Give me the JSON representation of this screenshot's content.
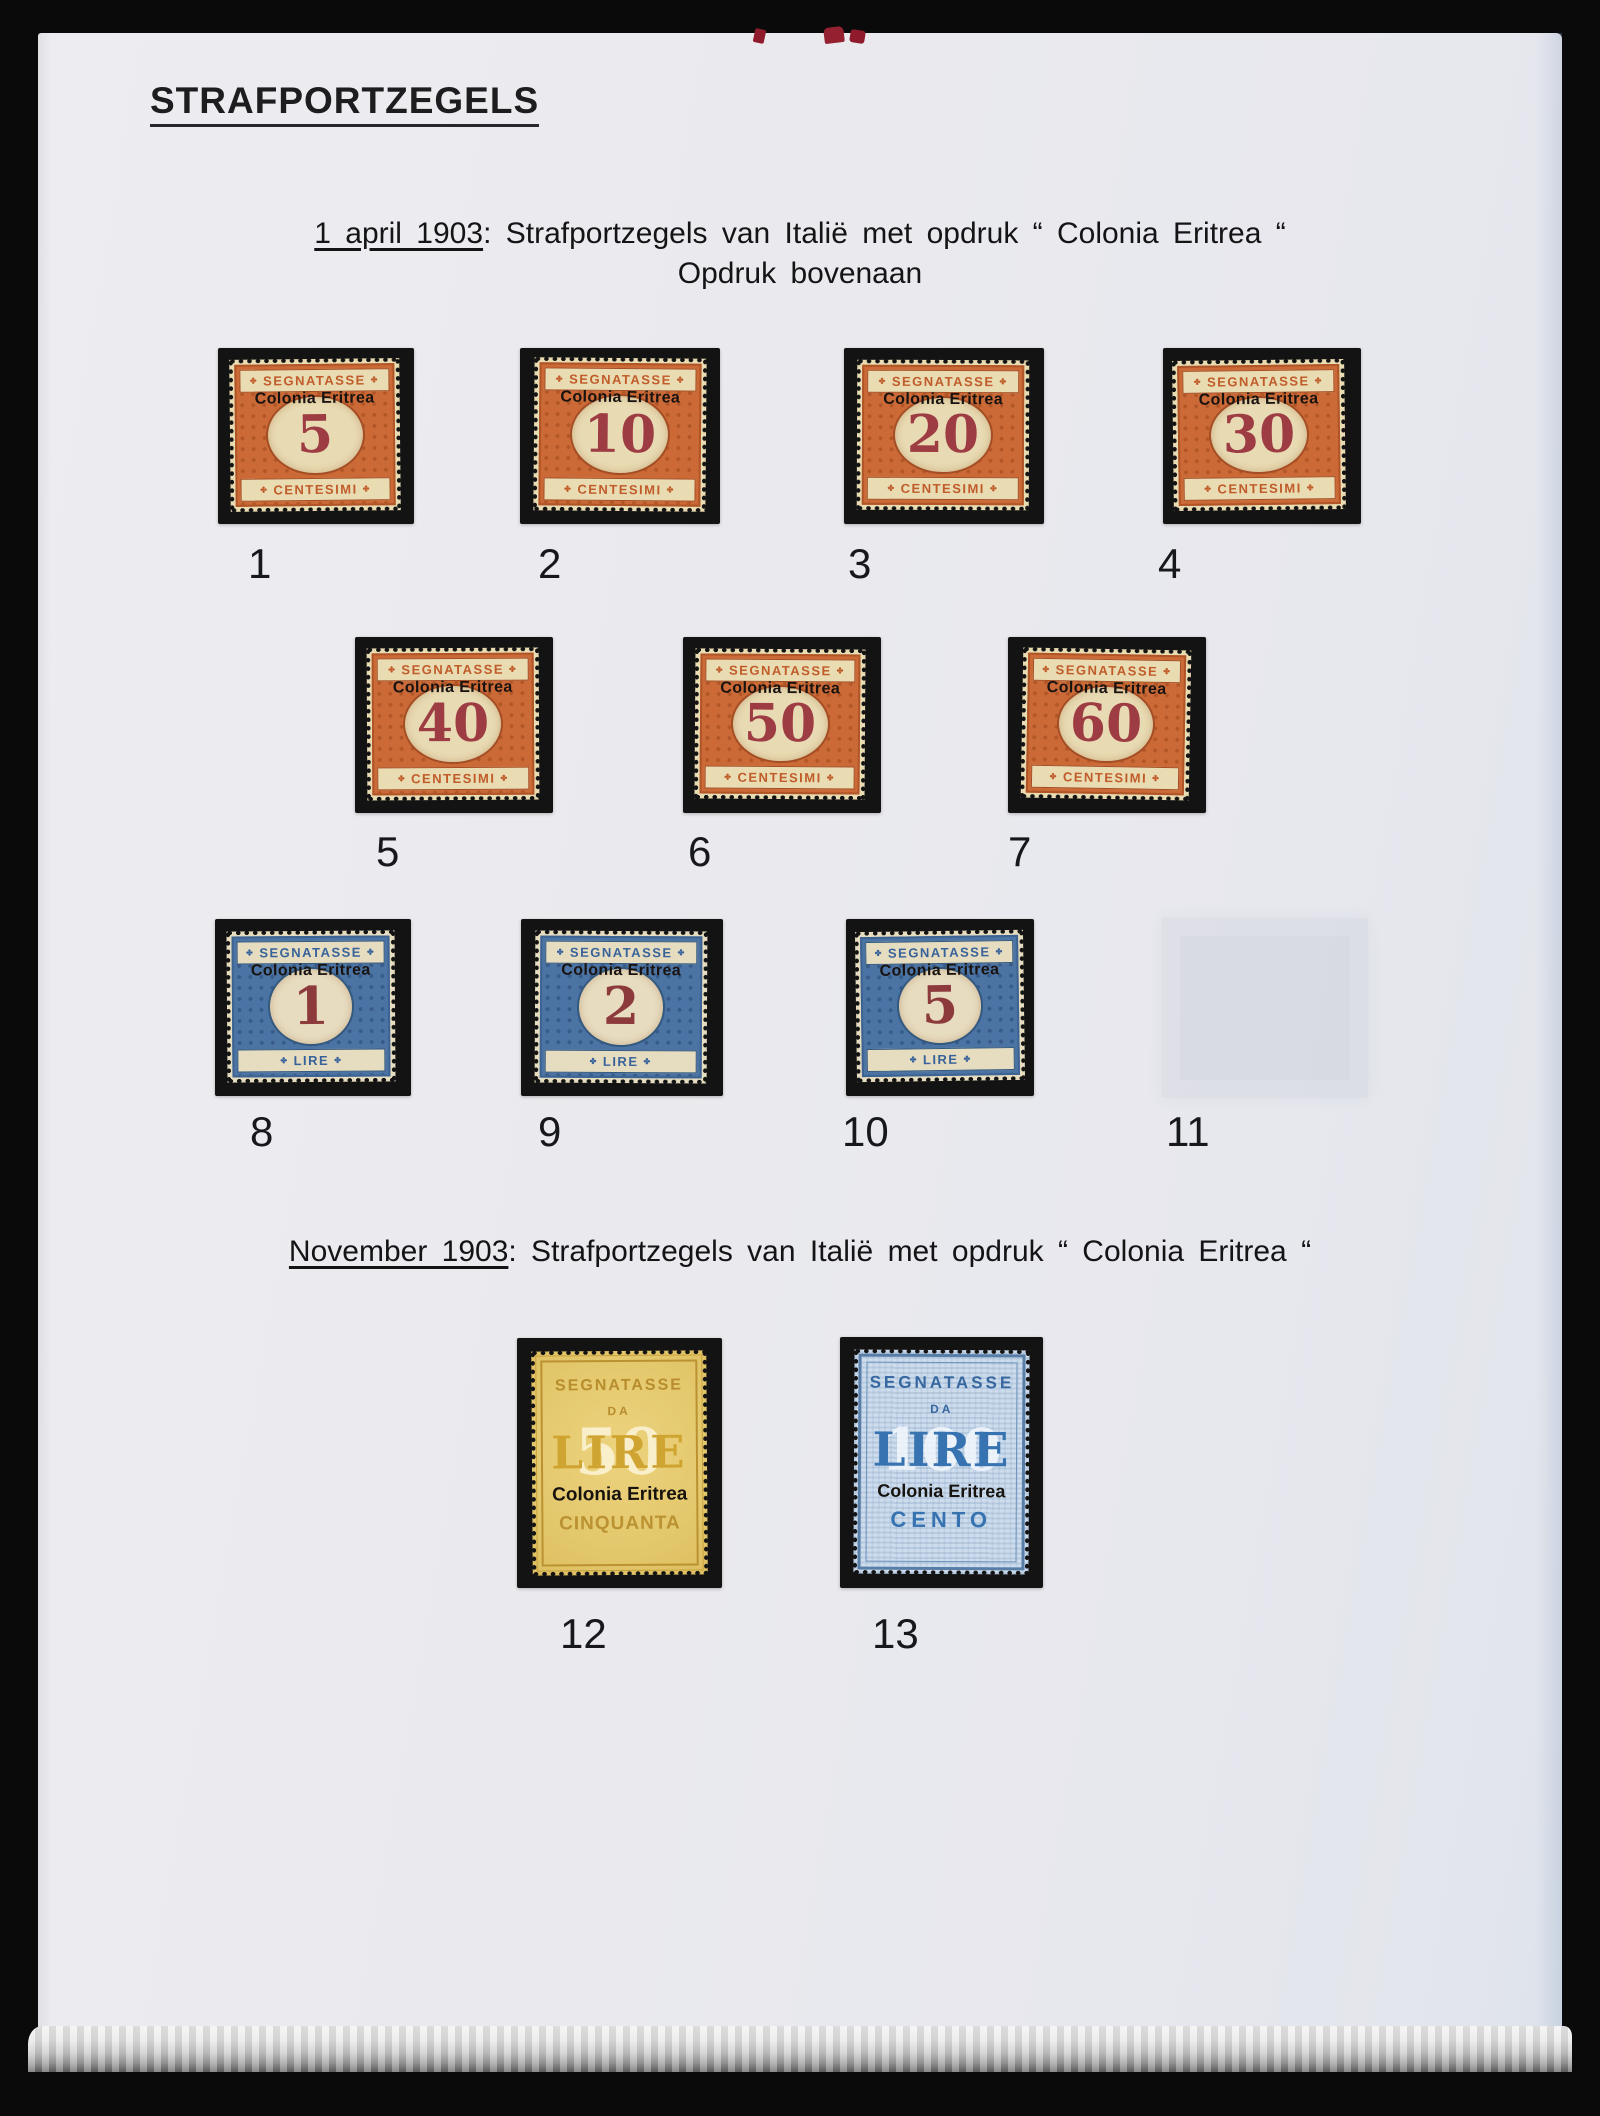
{
  "page": {
    "title": "STRAFPORTZEGELS",
    "section_april": {
      "date": "1 april 1903",
      "text": ": Strafportzegels van Italië met opdruk “ Colonia Eritrea “",
      "subtext": "Opdruk bovenaan"
    },
    "section_november": {
      "date": "November 1903",
      "text": ": Strafportzegels van Italië met opdruk “ Colonia Eritrea “"
    }
  },
  "stamps": [
    {
      "number": "1",
      "header": "SEGNATASSE",
      "overprint": "Colonia Eritrea",
      "value": "5",
      "footer": "CENTESIMI"
    },
    {
      "number": "2",
      "header": "SEGNATASSE",
      "overprint": "Colonia Eritrea",
      "value": "10",
      "footer": "CENTESIMI"
    },
    {
      "number": "3",
      "header": "SEGNATASSE",
      "overprint": "Colonia Eritrea",
      "value": "20",
      "footer": "CENTESIMI"
    },
    {
      "number": "4",
      "header": "SEGNATASSE",
      "overprint": "Colonia Eritrea",
      "value": "30",
      "footer": "CENTESIMI"
    },
    {
      "number": "5",
      "header": "SEGNATASSE",
      "overprint": "Colonia Eritrea",
      "value": "40",
      "footer": "CENTESIMI"
    },
    {
      "number": "6",
      "header": "SEGNATASSE",
      "overprint": "Colonia Eritrea",
      "value": "50",
      "footer": "CENTESIMI"
    },
    {
      "number": "7",
      "header": "SEGNATASSE",
      "overprint": "Colonia Eritrea",
      "value": "60",
      "footer": "CENTESIMI"
    },
    {
      "number": "8",
      "header": "SEGNATASSE",
      "overprint": "Colonia Eritrea",
      "value": "1",
      "footer": "LIRE"
    },
    {
      "number": "9",
      "header": "SEGNATASSE",
      "overprint": "Colonia Eritrea",
      "value": "2",
      "footer": "LIRE"
    },
    {
      "number": "10",
      "header": "SEGNATASSE",
      "overprint": "Colonia Eritrea",
      "value": "5",
      "footer": "LIRE"
    },
    {
      "number": "11",
      "empty": true
    },
    {
      "number": "12",
      "header": "SEGNATASSE",
      "da": "DA",
      "lire": "LIRE",
      "ghost": "50",
      "overprint": "Colonia Eritrea",
      "bottom": "CINQUANTA"
    },
    {
      "number": "13",
      "header": "SEGNATASSE",
      "da": "DA",
      "lire": "LIRE",
      "ghost": "100",
      "overprint": "Colonia Eritrea",
      "bottom": "CENTO"
    }
  ],
  "colors": {
    "photo_background": "#0a0a0a",
    "page_background": "#eaeaee",
    "mount_black": "#131313",
    "paper_cream": "#e9dbb2",
    "orange_frame": "#cb6a36",
    "orange_text": "#c05c2a",
    "carmine_numeral": "#9e3c44",
    "blue_frame": "#4b73a3",
    "blue_text": "#38639a",
    "dark_red_numeral": "#8c3a3c",
    "yellow_paper": "#e4c86d",
    "yellow_text": "#b78d2d",
    "lightblue_paper": "#cedded",
    "lightblue_text": "#3673b0",
    "overprint_black": "#17130e",
    "red_ink": "#8e1a2c"
  }
}
